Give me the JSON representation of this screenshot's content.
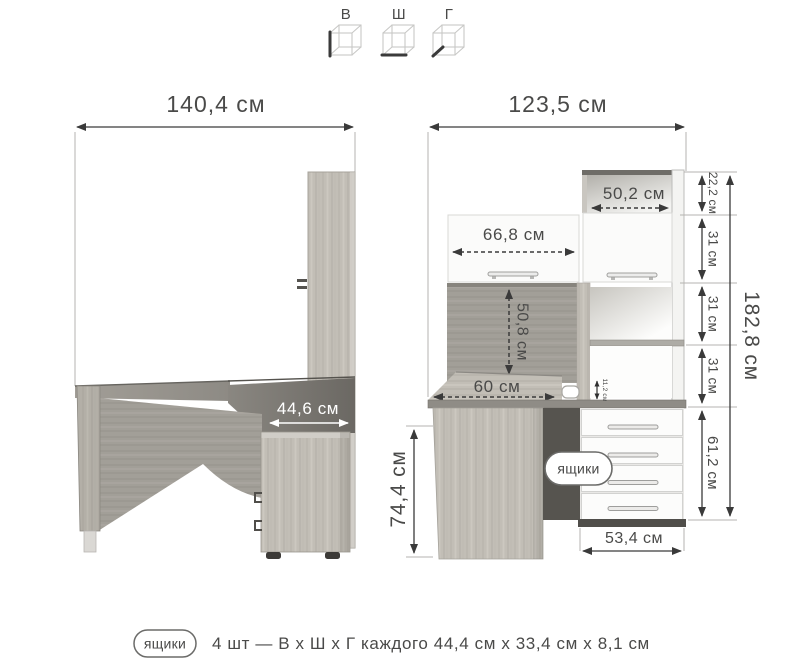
{
  "palette": {
    "background": "#ffffff",
    "text": "#4a4a49",
    "dimension_line": "#3a3a3a",
    "extension_line": "#b5b3b0",
    "wood_light": "#c2beb6",
    "wood_dark": "#9d9992",
    "front_white": "#fcfcfb",
    "shadow_dark": "#56544f",
    "white_label": "#ffffff"
  },
  "legend": {
    "axes": [
      {
        "label": "В"
      },
      {
        "label": "Ш"
      },
      {
        "label": "Г"
      }
    ]
  },
  "side_view": {
    "overall_width": "140,4 см",
    "unit_depth": "44,6 см"
  },
  "front_view": {
    "overall_width": "123,5 см",
    "top_niche_width": "50,2 см",
    "door_width": "66,8 см",
    "under_shelf_clearance": "50,8 см",
    "desktop_depth": "60 см",
    "desktop_gap": "11,2 см",
    "desk_height": "74,4 см",
    "drawer_unit_width": "53,4 см",
    "drawers_badge": "ящики",
    "height_segments": [
      "22,2 см",
      "31 см",
      "31 см",
      "31 см",
      "61,2 см"
    ],
    "total_height": "182,8 см"
  },
  "footnote": {
    "badge": "ящики",
    "text": "4 шт — В х Ш х Г каждого 44,4 см х 33,4 см х 8,1 см"
  }
}
